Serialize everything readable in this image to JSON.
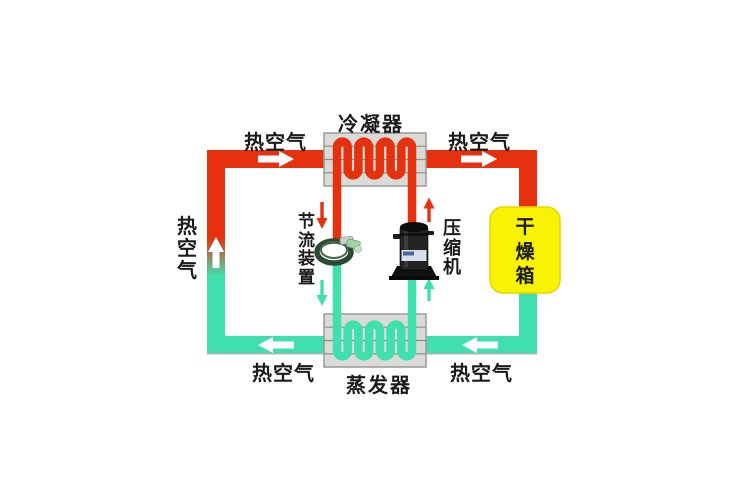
{
  "components": {
    "condenser": {
      "label": "冷凝器"
    },
    "evaporator": {
      "label": "蒸发器"
    },
    "compressor": {
      "label": "压缩机"
    },
    "throttle_device": {
      "label": "节流装置"
    },
    "drying_box": {
      "label": "干燥箱"
    }
  },
  "air_flow_labels": {
    "top_left": "热空气",
    "top_right": "热空气",
    "left_side": "热空气",
    "bottom_left": "热空气",
    "bottom_right": "热空气"
  },
  "arrows": {
    "air": [
      {
        "location": "top-left-duct",
        "direction": "right",
        "color": "white"
      },
      {
        "location": "top-right-duct",
        "direction": "right",
        "color": "white"
      },
      {
        "location": "left-duct",
        "direction": "up",
        "color": "white"
      },
      {
        "location": "bottom-left-duct",
        "direction": "left",
        "color": "white"
      },
      {
        "location": "bottom-right-duct",
        "direction": "left",
        "color": "white"
      }
    ],
    "refrigerant": [
      {
        "location": "condenser-to-throttle",
        "direction": "down",
        "color": "red"
      },
      {
        "location": "throttle-to-evaporator",
        "direction": "down",
        "color": "teal"
      },
      {
        "location": "evaporator-to-compressor",
        "direction": "up",
        "color": "teal"
      },
      {
        "location": "compressor-to-condenser",
        "direction": "up",
        "color": "red"
      }
    ]
  },
  "colors": {
    "hot-air": "#e5310e",
    "cool-air": "#3fe0ae",
    "drying-box-fill": "#f7f303",
    "heat-exchanger-fill": "#dadad6",
    "heat-exchanger-border": "#9a9a9a",
    "label-text": "#1b1b1b"
  }
}
